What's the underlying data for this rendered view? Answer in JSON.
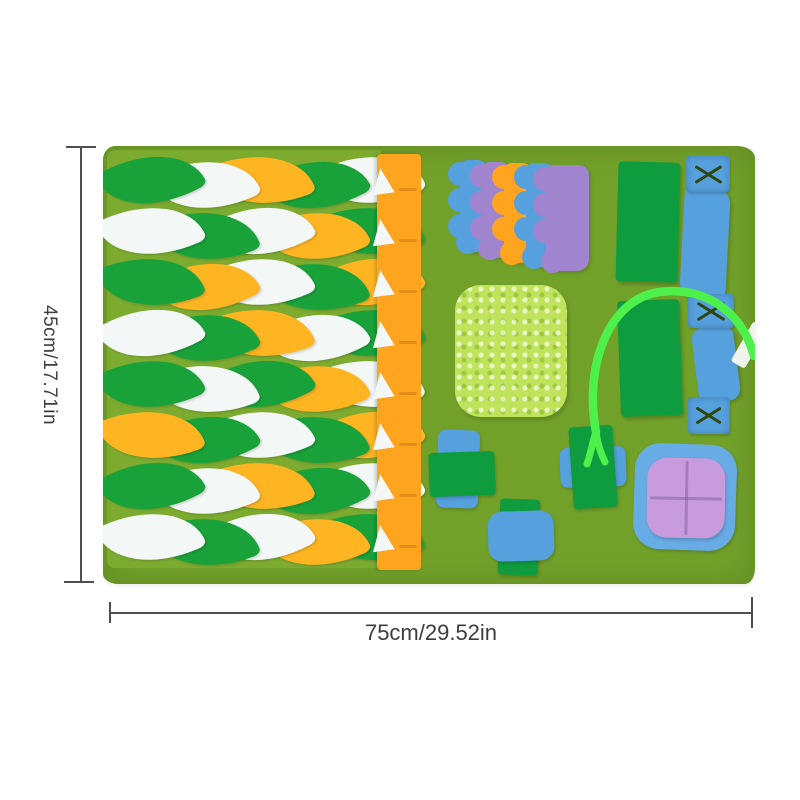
{
  "page": {
    "background": "#ffffff",
    "description": "Product photo of a felt pet snuffle / foraging mat shown with dimension annotations"
  },
  "annotations": {
    "height_label": "45cm/17.71in",
    "width_label": "75cm/29.52in"
  },
  "colors": {
    "olive": "#72a12a",
    "olive_light": "#7cab30",
    "leaf_green": "#19a23a",
    "leaf_white": "#f3f7f6",
    "leaf_orange": "#ffb522",
    "strip_orange": "#ffa41f",
    "pocket_green": "#0f9c3e",
    "strap_blue": "#56a0dd",
    "purple": "#a184ce",
    "chenille_green": "#bfe45c",
    "ribbon_green": "#4ef04b",
    "pillow_blue": "#68ace6",
    "pillow_purple": "#c79bdc",
    "white_accent": "#eef3ec",
    "stitch": "#31450e",
    "dim_line": "#4f4f4f",
    "dim_text": "#3d3d3d"
  },
  "mat": {
    "leaf_field": {
      "rows": 8,
      "leaves_per_row": 5,
      "palette_keys": [
        "leaf_green",
        "leaf_white",
        "leaf_orange"
      ],
      "row_patterns": [
        [
          0,
          1,
          2,
          0,
          1
        ],
        [
          1,
          0,
          1,
          2,
          0
        ],
        [
          0,
          2,
          1,
          0,
          2
        ],
        [
          1,
          0,
          2,
          1,
          0
        ],
        [
          0,
          1,
          0,
          2,
          1
        ],
        [
          2,
          0,
          1,
          0,
          2
        ],
        [
          0,
          1,
          2,
          0,
          1
        ],
        [
          1,
          0,
          1,
          2,
          0
        ]
      ]
    },
    "orange_strip": {
      "slit_count": 8
    },
    "scallop_color_keys": [
      "strap_blue",
      "purple",
      "strip_orange",
      "strap_blue",
      "purple"
    ],
    "x_stitch_count": 3
  }
}
